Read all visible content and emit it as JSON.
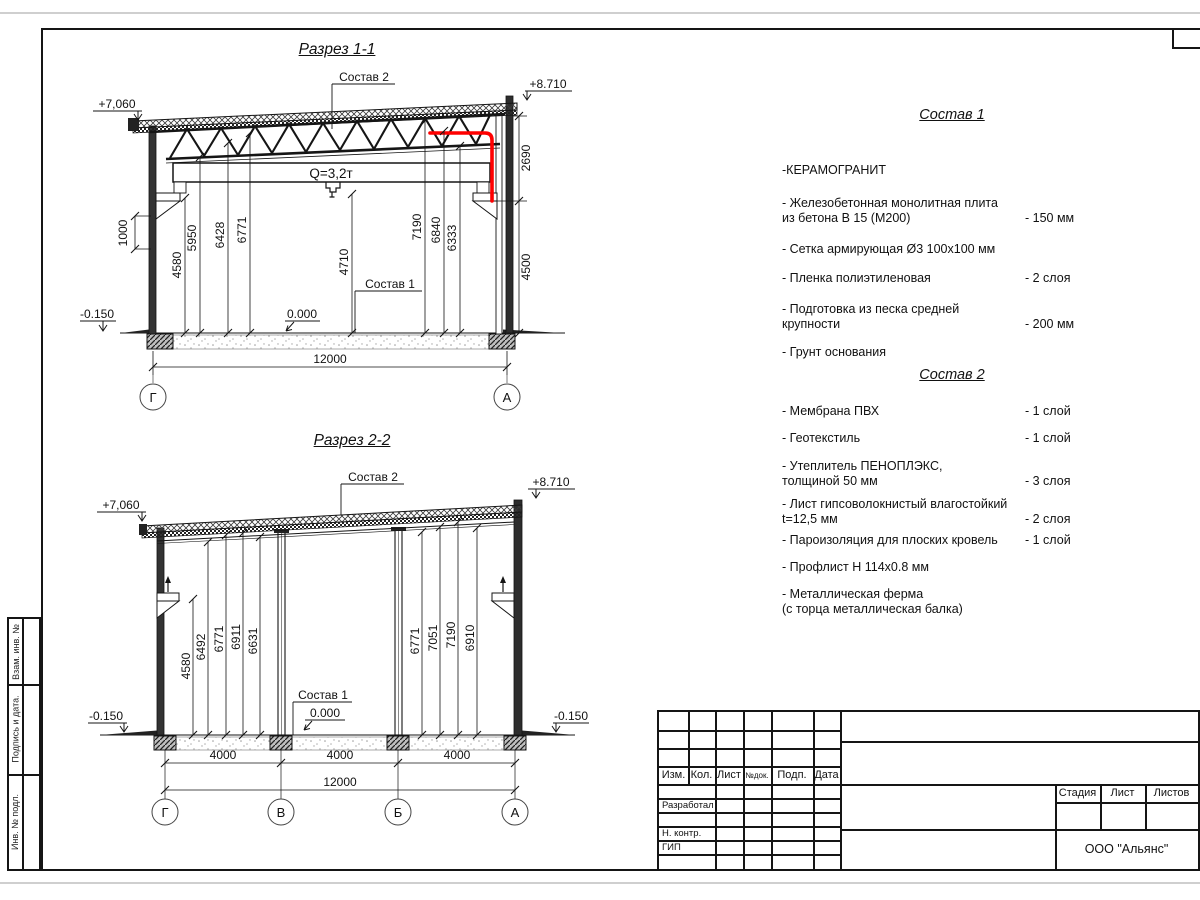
{
  "section1": {
    "title": "Разрез 1-1",
    "sostav2_label": "Состав 2",
    "sostav1_label": "Состав 1",
    "elev_left": "+7,060",
    "elev_right": "+8.710",
    "elev_zero": "0.000",
    "elev_ground": "-0.150",
    "crane": "Q=3,2т",
    "dim_wall": "1000",
    "dim_parapet": "2690",
    "dim_right": "4500",
    "dims": [
      "4580",
      "5950",
      "6428",
      "6771",
      "4710",
      "7190",
      "6840",
      "6333"
    ],
    "span": "12000",
    "grids": [
      "Г",
      "А"
    ]
  },
  "section2": {
    "title": "Разрез 2-2",
    "sostav2_label": "Состав 2",
    "sostav1_label": "Состав 1",
    "elev_left": "+7,060",
    "elev_right": "+8.710",
    "elev_zero": "0.000",
    "elev_ground_left": "-0.150",
    "elev_ground_right": "-0.150",
    "dims": [
      "4580",
      "6492",
      "6771",
      "6911",
      "6631",
      "6771",
      "7051",
      "7190",
      "6910"
    ],
    "bays": [
      "4000",
      "4000",
      "4000"
    ],
    "span": "12000",
    "grids": [
      "Г",
      "В",
      "Б",
      "А"
    ]
  },
  "sostav1": {
    "title": "Состав 1",
    "items": [
      {
        "text": "-КЕРАМОГРАНИТ",
        "value": ""
      },
      {
        "text": "- Железобетонная монолитная плита\nиз бетона В 15 (М200)",
        "value": "- 150 мм"
      },
      {
        "text": "- Сетка армирующая Ø3 100х100 мм",
        "value": ""
      },
      {
        "text": "- Пленка полиэтиленовая",
        "value": "-  2 слоя"
      },
      {
        "text": "- Подготовка из песка средней\nкрупности",
        "value": "- 200 мм"
      },
      {
        "text": "- Грунт основания",
        "value": ""
      }
    ]
  },
  "sostav2": {
    "title": "Состав 2",
    "items": [
      {
        "text": "- Мембрана ПВХ",
        "value": "- 1 слой"
      },
      {
        "text": "- Геотекстиль",
        "value": "- 1 слой"
      },
      {
        "text": "- Утеплитель ПЕНОПЛЭКС,\nтолщиной 50 мм",
        "value": "- 3 слоя"
      },
      {
        "text": "- Лист гипсоволокнистый влагостойкий\nt=12,5 мм",
        "value": "- 2 слоя"
      },
      {
        "text": "- Пароизоляция для плоских кровель",
        "value": "- 1 слой"
      },
      {
        "text": "- Профлист Н 114х0.8 мм",
        "value": ""
      },
      {
        "text": "- Металлическая ферма\n(с торца металлическая балка)",
        "value": ""
      }
    ]
  },
  "titleblock": {
    "headers": [
      "Изм.",
      "Кол.",
      "Лист",
      "№док.",
      "Подп.",
      "Дата"
    ],
    "roles": [
      "Разработал",
      "Н. контр.",
      "ГИП"
    ],
    "stage_label": "Стадия",
    "sheet_label": "Лист",
    "sheets_label": "Листов",
    "company": "ООО \"Альянс\""
  },
  "side_stamp": {
    "cells": [
      "Взам. инв. №",
      "Подпись  и  дата.",
      "Инв. № подл."
    ]
  },
  "colors": {
    "highlight": "#ff0000"
  }
}
